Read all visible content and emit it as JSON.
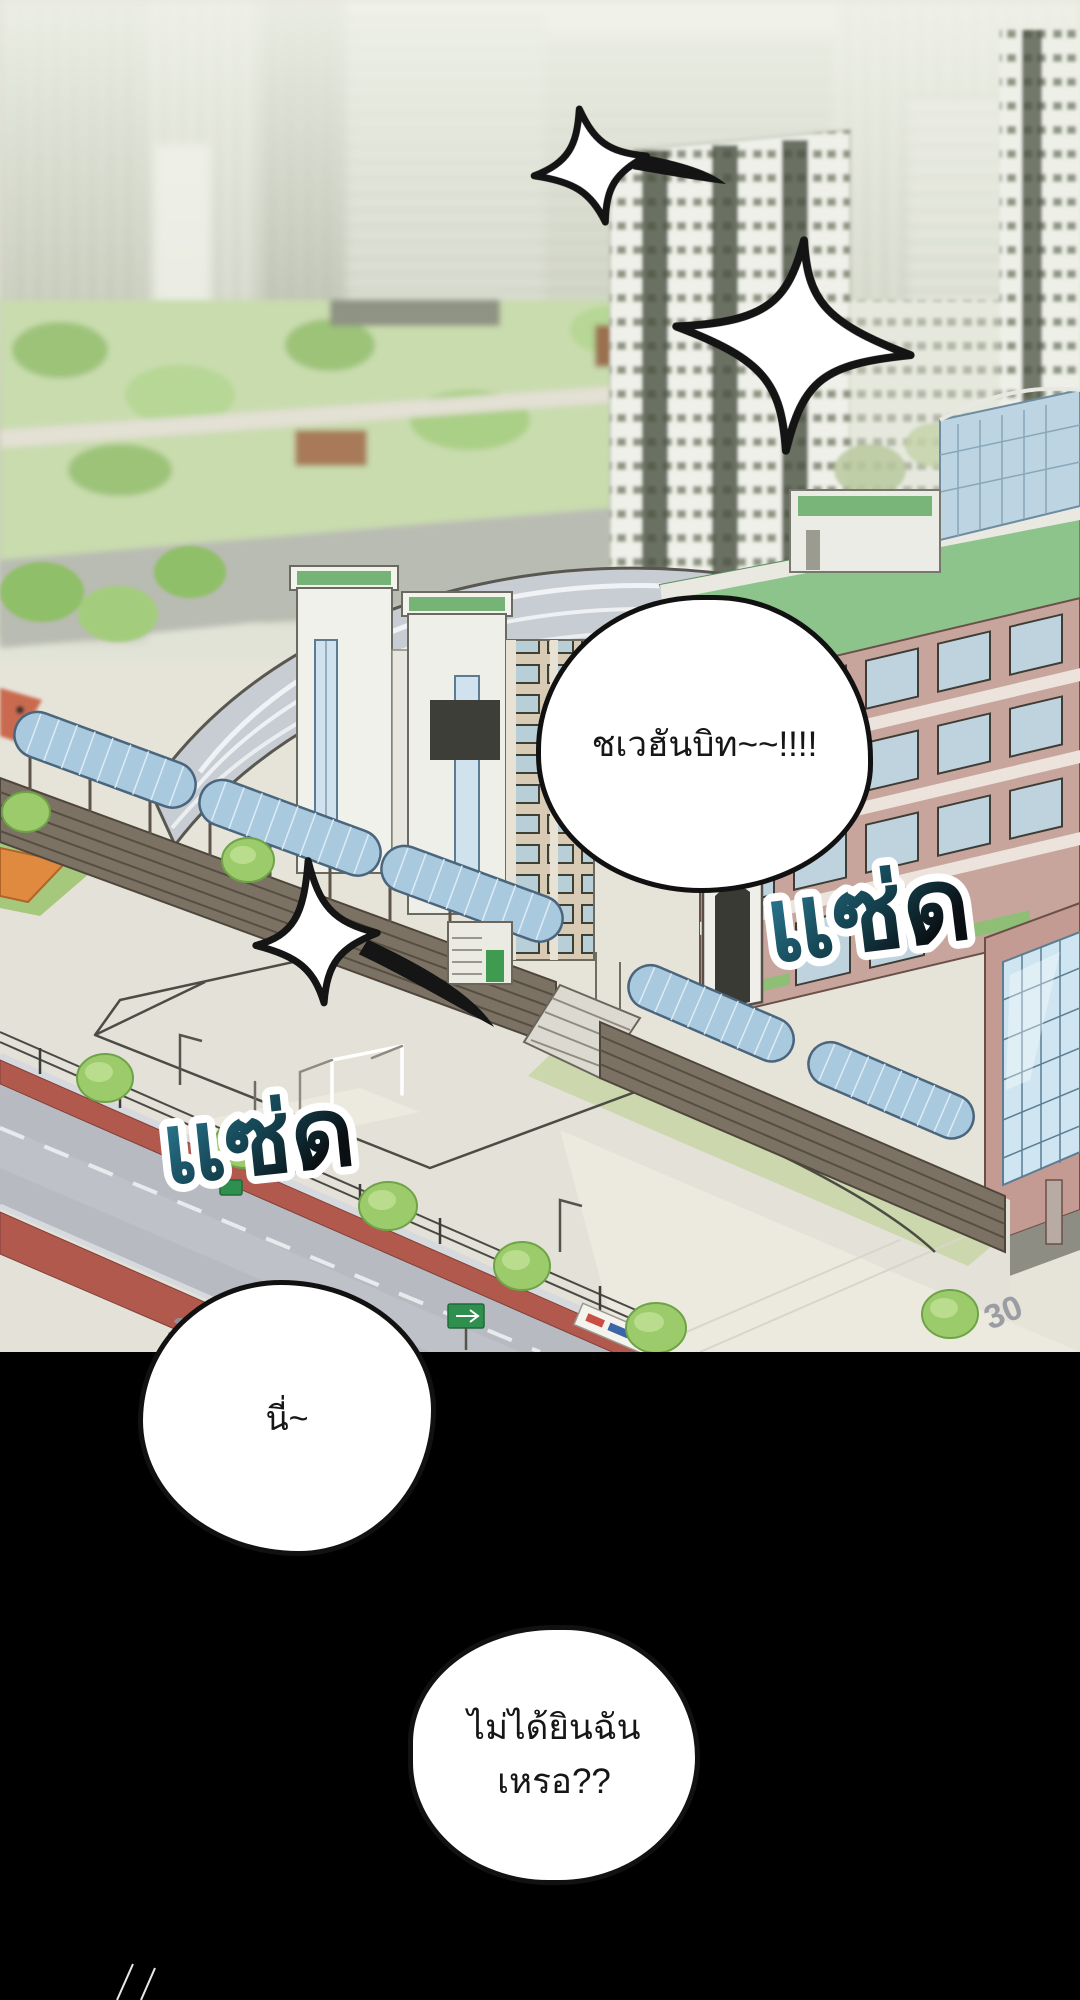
{
  "panel": {
    "type": "webtoon comic panel",
    "scene": "Aerial isometric view of a school campus with playground, covered walkways, apartment towers and hazy city skyline; lower half fades to black"
  },
  "speech_bubbles": [
    {
      "text": "ชเวฮันบิท~~!!!!"
    },
    {
      "text": "นี่~"
    },
    {
      "line1": "ไม่ได้ยินฉัน",
      "line2": "เหรอ??"
    }
  ],
  "sfx": [
    {
      "text": "แซ่ด"
    },
    {
      "text": "แซ่ด"
    }
  ],
  "road_markings": {
    "left": "30",
    "right": "30"
  },
  "colors": {
    "sfx_gradient_start": "#2f86a3",
    "sfx_gradient_mid": "#14424f",
    "sfx_gradient_end": "#0a0f13",
    "sfx_outline": "#ffffff",
    "bubble_fill": "#ffffff",
    "bubble_stroke": "#111111",
    "panel_background": "#000000",
    "playground": "#e4e1d8",
    "green_roof": "#8cc48c",
    "school_wall": "#c8a59c",
    "canopy_glass": "#a9c9de",
    "sidewalk_red": "#b2594e"
  }
}
